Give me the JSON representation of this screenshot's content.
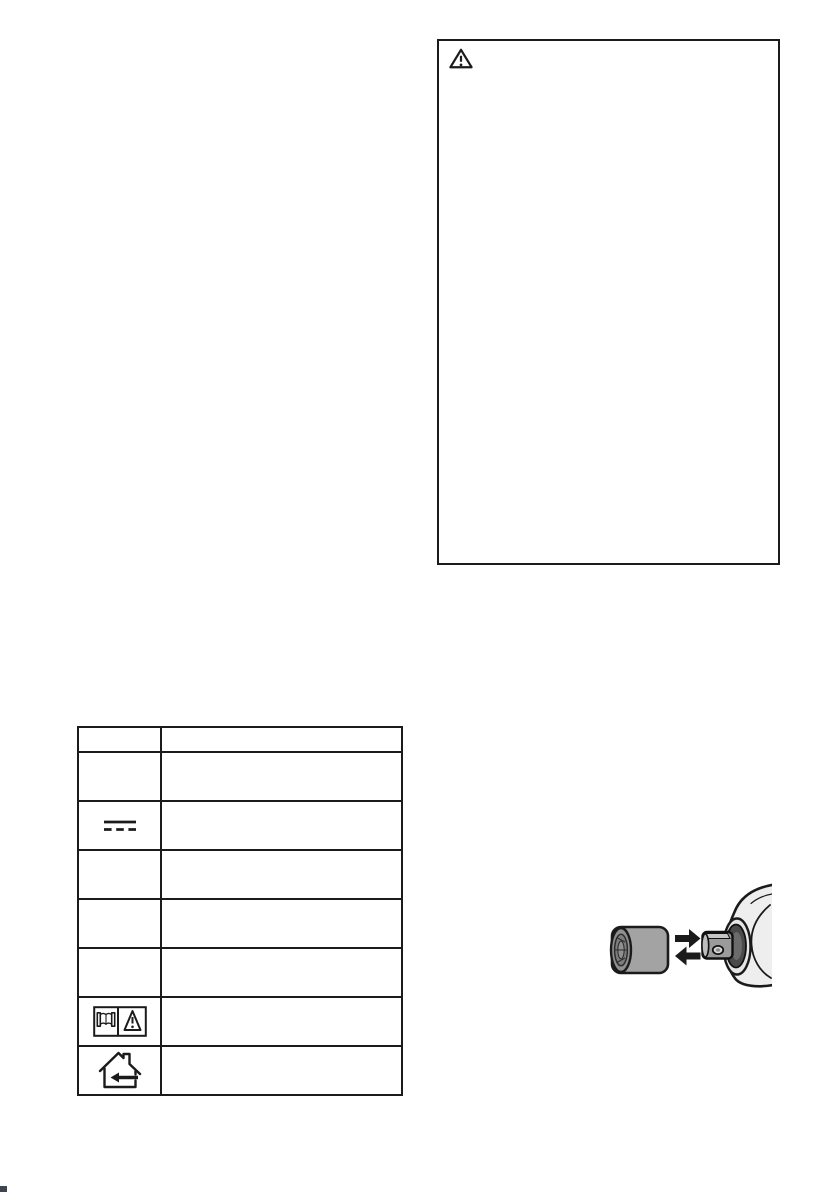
{
  "page": {
    "kind": "instruction-manual-scan",
    "background": "#ffffff"
  },
  "colors": {
    "line": "#1b1b1b",
    "socket_body": "#a3a3a3",
    "socket_face": "#8f8f8f",
    "socket_recess": "#7d7d7d",
    "tool_body": "#eeeeee",
    "tool_face": "#e6e6e6",
    "collar_dark": "#4a4a4a",
    "anvil_body": "#9b9b9b",
    "anvil_top": "#c6c6c6",
    "artifact": "#1c2433",
    "page_background": "#ffffff"
  },
  "warning_box": {
    "icon": "warning",
    "content": ""
  },
  "icons": {
    "warning": "warning-triangle-icon",
    "direct_current": "direct-current-icon",
    "read_manual_warning": "read-manual-warning-icon",
    "indoor_use_only": "indoor-use-only-icon"
  },
  "symbols_table": {
    "columns": [
      "symbol",
      "description"
    ],
    "rows": [
      {
        "kind": "header",
        "symbol": null,
        "description": ""
      },
      {
        "kind": "body",
        "symbol": null,
        "description": ""
      },
      {
        "kind": "body",
        "symbol": "direct_current",
        "description": ""
      },
      {
        "kind": "body",
        "symbol": null,
        "description": ""
      },
      {
        "kind": "body",
        "symbol": null,
        "description": ""
      },
      {
        "kind": "body",
        "symbol": null,
        "description": ""
      },
      {
        "kind": "body",
        "symbol": "read_manual_warning",
        "description": ""
      },
      {
        "kind": "body",
        "symbol": "indoor_use_only",
        "description": ""
      }
    ]
  },
  "figure": {
    "name": "socket-attachment-figure",
    "parts": [
      "impact-socket",
      "insert-arrow",
      "remove-arrow",
      "square-drive-anvil",
      "tool-nose"
    ]
  }
}
